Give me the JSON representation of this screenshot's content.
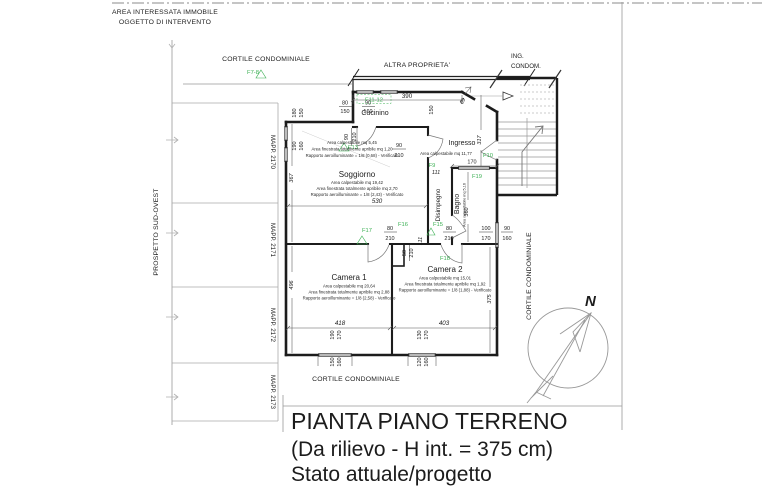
{
  "labels": {
    "area_line1": "AREA INTERESSATA IMMOBILE",
    "area_line2": "OGGETTO DI INTERVENTO",
    "cortile_top": "CORTILE CONDOMINIALE",
    "altra_proprieta": "ALTRA PROPRIETA'",
    "ing_line1": "ING.",
    "ing_line2": "CONDOM.",
    "prospetto": "PROSPETTO SUD-OVEST",
    "mapp_2170": "MAPP. 2170",
    "mapp_2171": "MAPP. 2171",
    "mapp_2172": "MAPP. 2172",
    "mapp_2173": "MAPP. 2173",
    "cortile_bottom": "CORTILE CONDOMINIALE",
    "cortile_right": "CORTILE CONDOMINIALE",
    "north": "N"
  },
  "rooms": {
    "cucinino": {
      "name": "Cucinino",
      "info": [
        "Area calpestabile mq 5,45",
        "Area finestrata totalmente apribile mq 1,20",
        "Rapporto aeroilluminante = 1/8 (0,68) - Verificato"
      ]
    },
    "ingresso": {
      "name": "Ingresso",
      "info": [
        "Area calpestabile mq 11,77"
      ]
    },
    "soggiorno": {
      "name": "Soggiorno",
      "info": [
        "Area calpestabile mq 19,42",
        "Area finestrata totalmente apribile mq 2,70",
        "Rapporto aeroilluminante = 1/8 (2,43) - Verificato"
      ]
    },
    "disimpegno": {
      "name": "Disimpegno",
      "info": []
    },
    "bagno": {
      "name": "Bagno",
      "info": [
        "Area calpestabile mq 5,16"
      ]
    },
    "camera1": {
      "name": "Camera 1",
      "info": [
        "Area calpestabile mq 20,64",
        "Area finestrata totalmente apribile mq 2,88",
        "Rapporto aeroilluminante = 1/8 (2,58) - Verificato"
      ]
    },
    "camera2": {
      "name": "Camera 2",
      "info": [
        "Area calpestabile mq 15,01",
        "Area finestrata totalmente apribile mq 1,92",
        "Rapporto aeroilluminante = 1/8 (1,88) - Verificato"
      ]
    }
  },
  "fixtures": {
    "f7_8": "F7-8",
    "f11_12": "F11-12",
    "f13": "F13",
    "f10": "F10",
    "f9": "F9",
    "f19": "F19",
    "f16": "F16",
    "f17": "F17",
    "f15": "F15",
    "f18": "F18"
  },
  "dims": {
    "wall390": "390",
    "win_top1_w": "80",
    "win_top1_h": "150",
    "win_top2_w": "90",
    "win_top2_h": "160",
    "door_cuc_w": "90",
    "door_cuc_h": "210",
    "cuc_side": "150",
    "entry_w": "69",
    "ingresso_len": "317",
    "win_left1_w": "180",
    "win_left1_h": "150",
    "win_left2_w": "190",
    "win_left2_h": "160",
    "sog_h": "367",
    "sog_w": "530",
    "door_sog_w": "90",
    "door_sog_h": "210",
    "hall_a": "111",
    "hall_b": "111",
    "bagno_top": "170",
    "bagno_len": "360",
    "door_c1_w": "80",
    "door_c1_h": "210",
    "door_c2_w": "80",
    "door_c2_h": "210",
    "door_small_w": "50",
    "door_small_h": "210",
    "win_bag1_w": "100",
    "win_bag1_h": "170",
    "win_bag2_w": "90",
    "win_bag2_h": "160",
    "cam1_h": "496",
    "cam1_w": "418",
    "cam2_w": "403",
    "cam2_h": "375",
    "win_c1a_w": "190",
    "win_c1a_h": "170",
    "win_c1b_w": "150",
    "win_c1b_h": "160",
    "win_c2a_w": "130",
    "win_c2a_h": "170",
    "win_c2b_w": "120",
    "win_c2b_h": "160"
  },
  "title": {
    "line1": "PIANTA PIANO TERRENO",
    "line2": "(Da rilievo - H int. = 375 cm)",
    "line3": "Stato attuale/progetto"
  },
  "colors": {
    "fixture_green": "#3cb054",
    "wall": "#1c1c1c",
    "boundary_gray": "#999999",
    "paper": "#ffffff"
  }
}
